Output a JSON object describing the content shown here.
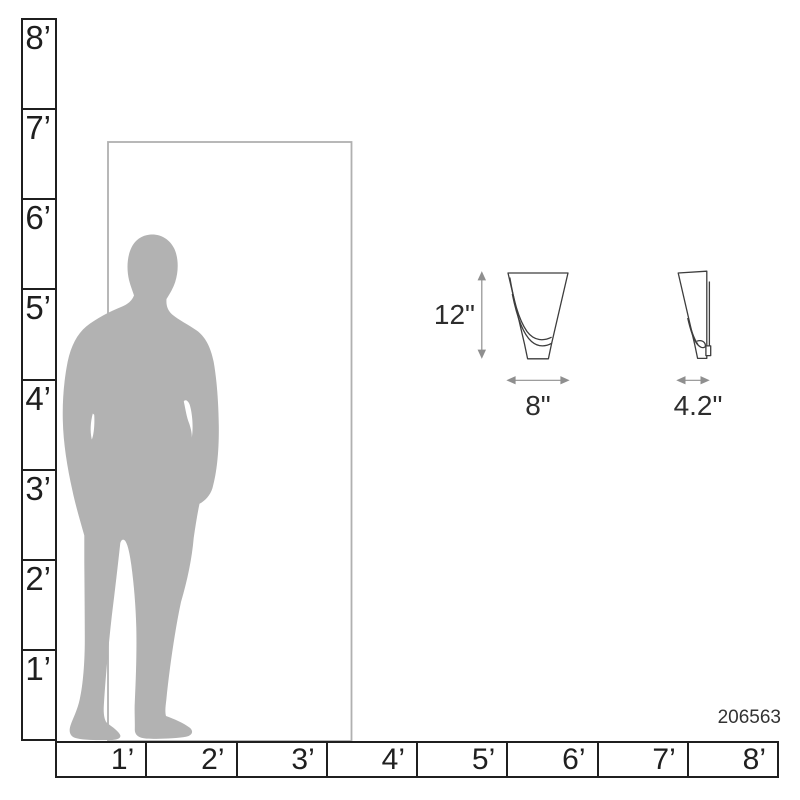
{
  "diagram": {
    "product_code": "206563",
    "fixture_dimensions": {
      "height_label": "12\"",
      "width_label": "8\"",
      "depth_label": "4.2\""
    },
    "vertical_ruler": {
      "unit": "feet",
      "labels": [
        "8’",
        "7’",
        "6’",
        "5’",
        "4’",
        "3’",
        "2’",
        "1’"
      ]
    },
    "horizontal_ruler": {
      "unit": "feet",
      "labels": [
        "1’",
        "2’",
        "3’",
        "4’",
        "5’",
        "6’",
        "7’",
        "8’"
      ]
    },
    "icons": {
      "person": "standing-man-silhouette",
      "door": "door-frame-outline",
      "front_view": "sconce-front-view-drawing",
      "side_view": "sconce-side-view-drawing"
    },
    "colors": {
      "ruler_line": "#1f1f1f",
      "silhouette_gray": "#b2b2b2",
      "door_frame_gray": "#b0b0b0",
      "drawing_line": "#3d3d3d",
      "dimension_line": "#8f8f8f"
    }
  }
}
